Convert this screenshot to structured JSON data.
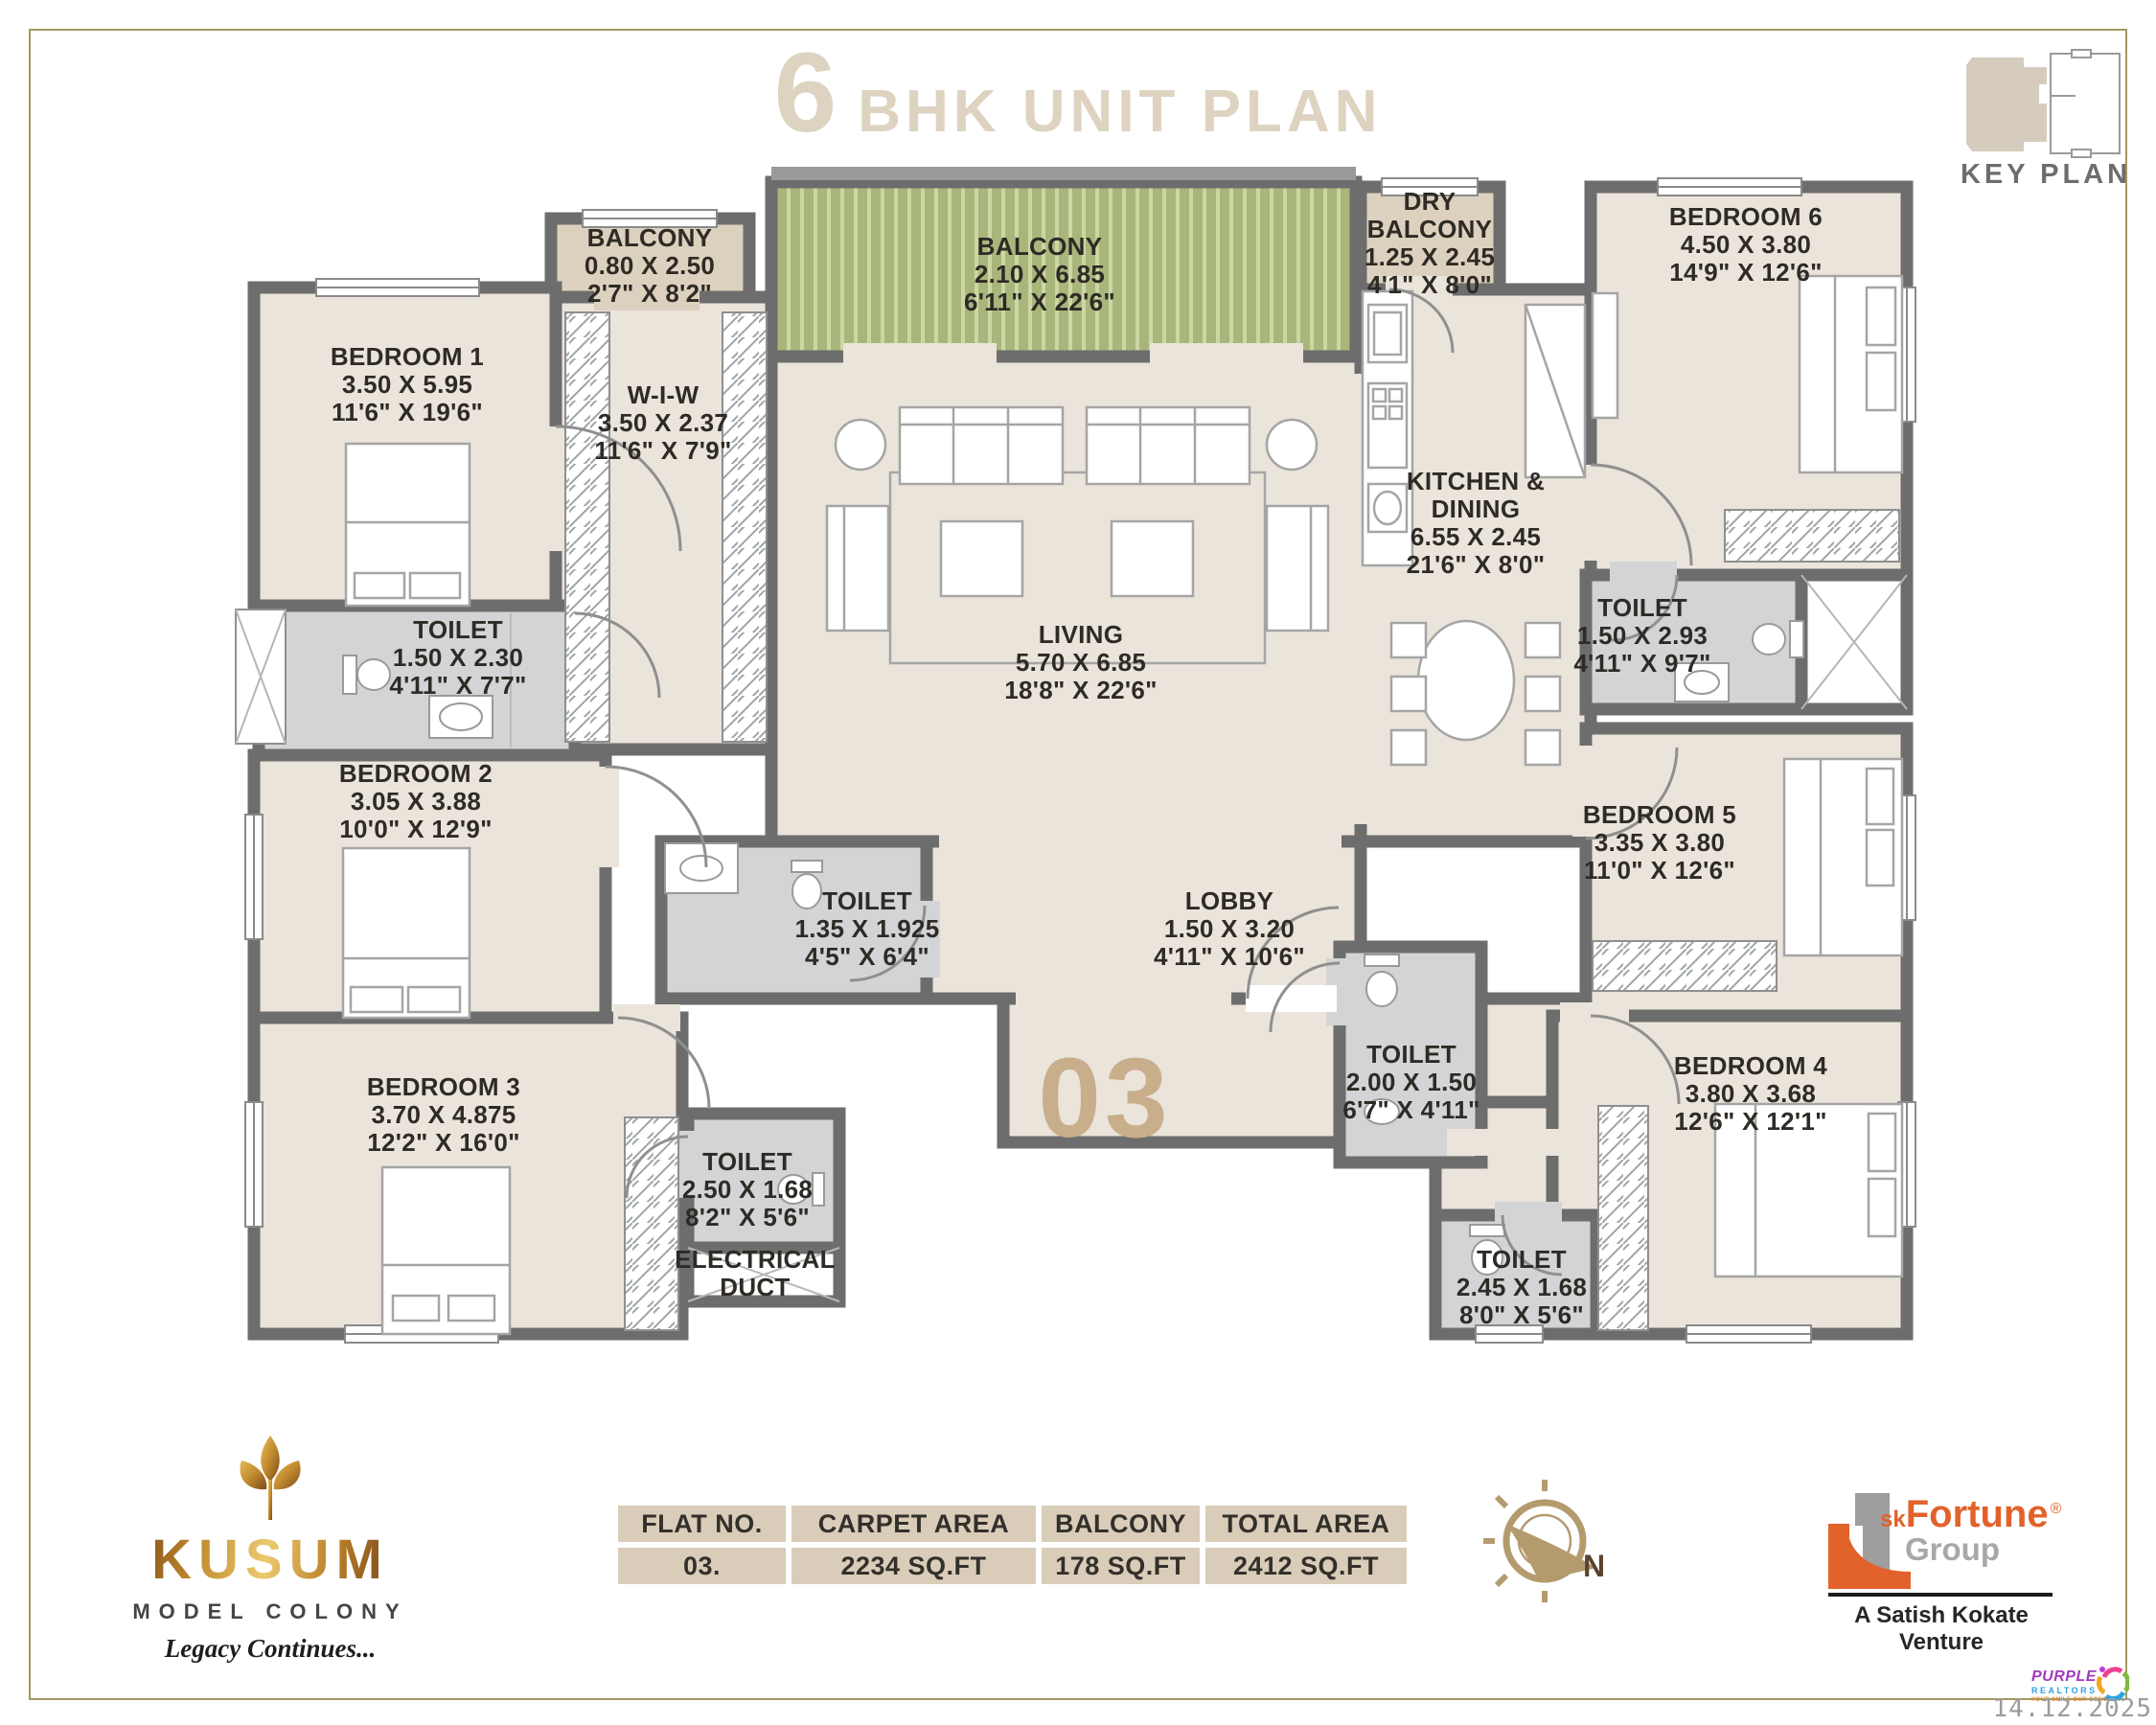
{
  "header": {
    "title_number": "6",
    "title_text": "BHK UNIT PLAN",
    "key_plan_label": "KEY PLAN"
  },
  "unit": {
    "number_label": "03"
  },
  "rooms": [
    {
      "id": "balcony-1",
      "name": "BALCONY",
      "dim_m": "0.80 X 2.50",
      "dim_ft": "2'7\" X 8'2\""
    },
    {
      "id": "bedroom-1",
      "name": "BEDROOM 1",
      "dim_m": "3.50 X 5.95",
      "dim_ft": "11'6\" X 19'6\""
    },
    {
      "id": "wiw",
      "name": "W-I-W",
      "dim_m": "3.50 X 2.37",
      "dim_ft": "11'6\" X 7'9\""
    },
    {
      "id": "balcony-main",
      "name": "BALCONY",
      "dim_m": "2.10 X 6.85",
      "dim_ft": "6'11\" X 22'6\""
    },
    {
      "id": "dry-balcony",
      "name": "DRY BALCONY",
      "dim_m": "1.25 X 2.45",
      "dim_ft": "4'1\" X 8'0\""
    },
    {
      "id": "bedroom-6",
      "name": "BEDROOM 6",
      "dim_m": "4.50 X 3.80",
      "dim_ft": "14'9\" X 12'6\""
    },
    {
      "id": "kitchen-dining",
      "name": "KITCHEN & DINING",
      "dim_m": "6.55 X 2.45",
      "dim_ft": "21'6\" X 8'0\""
    },
    {
      "id": "toilet-bed1",
      "name": "TOILET",
      "dim_m": "1.50 X 2.30",
      "dim_ft": "4'11\" X 7'7\""
    },
    {
      "id": "living",
      "name": "LIVING",
      "dim_m": "5.70 X 6.85",
      "dim_ft": "18'8\" X 22'6\""
    },
    {
      "id": "toilet-bed6",
      "name": "TOILET",
      "dim_m": "1.50 X 2.93",
      "dim_ft": "4'11\" X 9'7\""
    },
    {
      "id": "bedroom-2",
      "name": "BEDROOM 2",
      "dim_m": "3.05 X 3.88",
      "dim_ft": "10'0\" X 12'9\""
    },
    {
      "id": "bedroom-5",
      "name": "BEDROOM 5",
      "dim_m": "3.35 X 3.80",
      "dim_ft": "11'0\" X 12'6\""
    },
    {
      "id": "toilet-common",
      "name": "TOILET",
      "dim_m": "1.35 X 1.925",
      "dim_ft": "4'5\" X 6'4\""
    },
    {
      "id": "lobby",
      "name": "LOBBY",
      "dim_m": "1.50 X 3.20",
      "dim_ft": "4'11\" X 10'6\""
    },
    {
      "id": "toilet-bed5",
      "name": "TOILET",
      "dim_m": "2.00 X 1.50",
      "dim_ft": "6'7\" X 4'11\""
    },
    {
      "id": "bedroom-4",
      "name": "BEDROOM 4",
      "dim_m": "3.80 X 3.68",
      "dim_ft": "12'6\" X 12'1\""
    },
    {
      "id": "bedroom-3",
      "name": "BEDROOM 3",
      "dim_m": "3.70 X 4.875",
      "dim_ft": "12'2\" X 16'0\""
    },
    {
      "id": "toilet-bed3",
      "name": "TOILET",
      "dim_m": "2.50 X 1.68",
      "dim_ft": "8'2\" X 5'6\""
    },
    {
      "id": "electrical-duct",
      "name": "ELECTRICAL DUCT"
    },
    {
      "id": "toilet-bed4",
      "name": "TOILET",
      "dim_m": "2.45 X 1.68",
      "dim_ft": "8'0\" X 5'6\""
    }
  ],
  "area_table": {
    "headers": [
      "FLAT NO.",
      "CARPET AREA",
      "BALCONY",
      "TOTAL AREA"
    ],
    "row": [
      "03.",
      "2234 SQ.FT",
      "178 SQ.FT",
      "2412 SQ.FT"
    ]
  },
  "footer": {
    "kusum": {
      "brand": "KUSUM",
      "subtitle": "MODEL COLONY",
      "tagline": "Legacy Continues..."
    },
    "compass": {
      "north": "N"
    },
    "sk_fortune": {
      "prefix": "sk",
      "name": "Fortune",
      "registered": "®",
      "group": "Group",
      "tagline": "A Satish Kokate Venture"
    },
    "purple_realtors": {
      "name": "PURPLE",
      "type": "REALTORS",
      "tagline": "YOUR SMILE OUR CONCERN"
    },
    "date": "14.12.2025"
  },
  "colors": {
    "wall": "#6d6d6d",
    "room_fill": "#eae4db",
    "toilet_fill": "#d2d4d5",
    "balcony_tan": "#dcd1be",
    "balcony_green": "#a8b67b",
    "title_beige": "#ddd3c0",
    "unit_number_tan": "#c9ae8c",
    "table_cell": "#d9cdb9",
    "frame_gold": "#a59760",
    "brand_orange": "#e2622b",
    "brand_gold": "#c08a2e"
  }
}
